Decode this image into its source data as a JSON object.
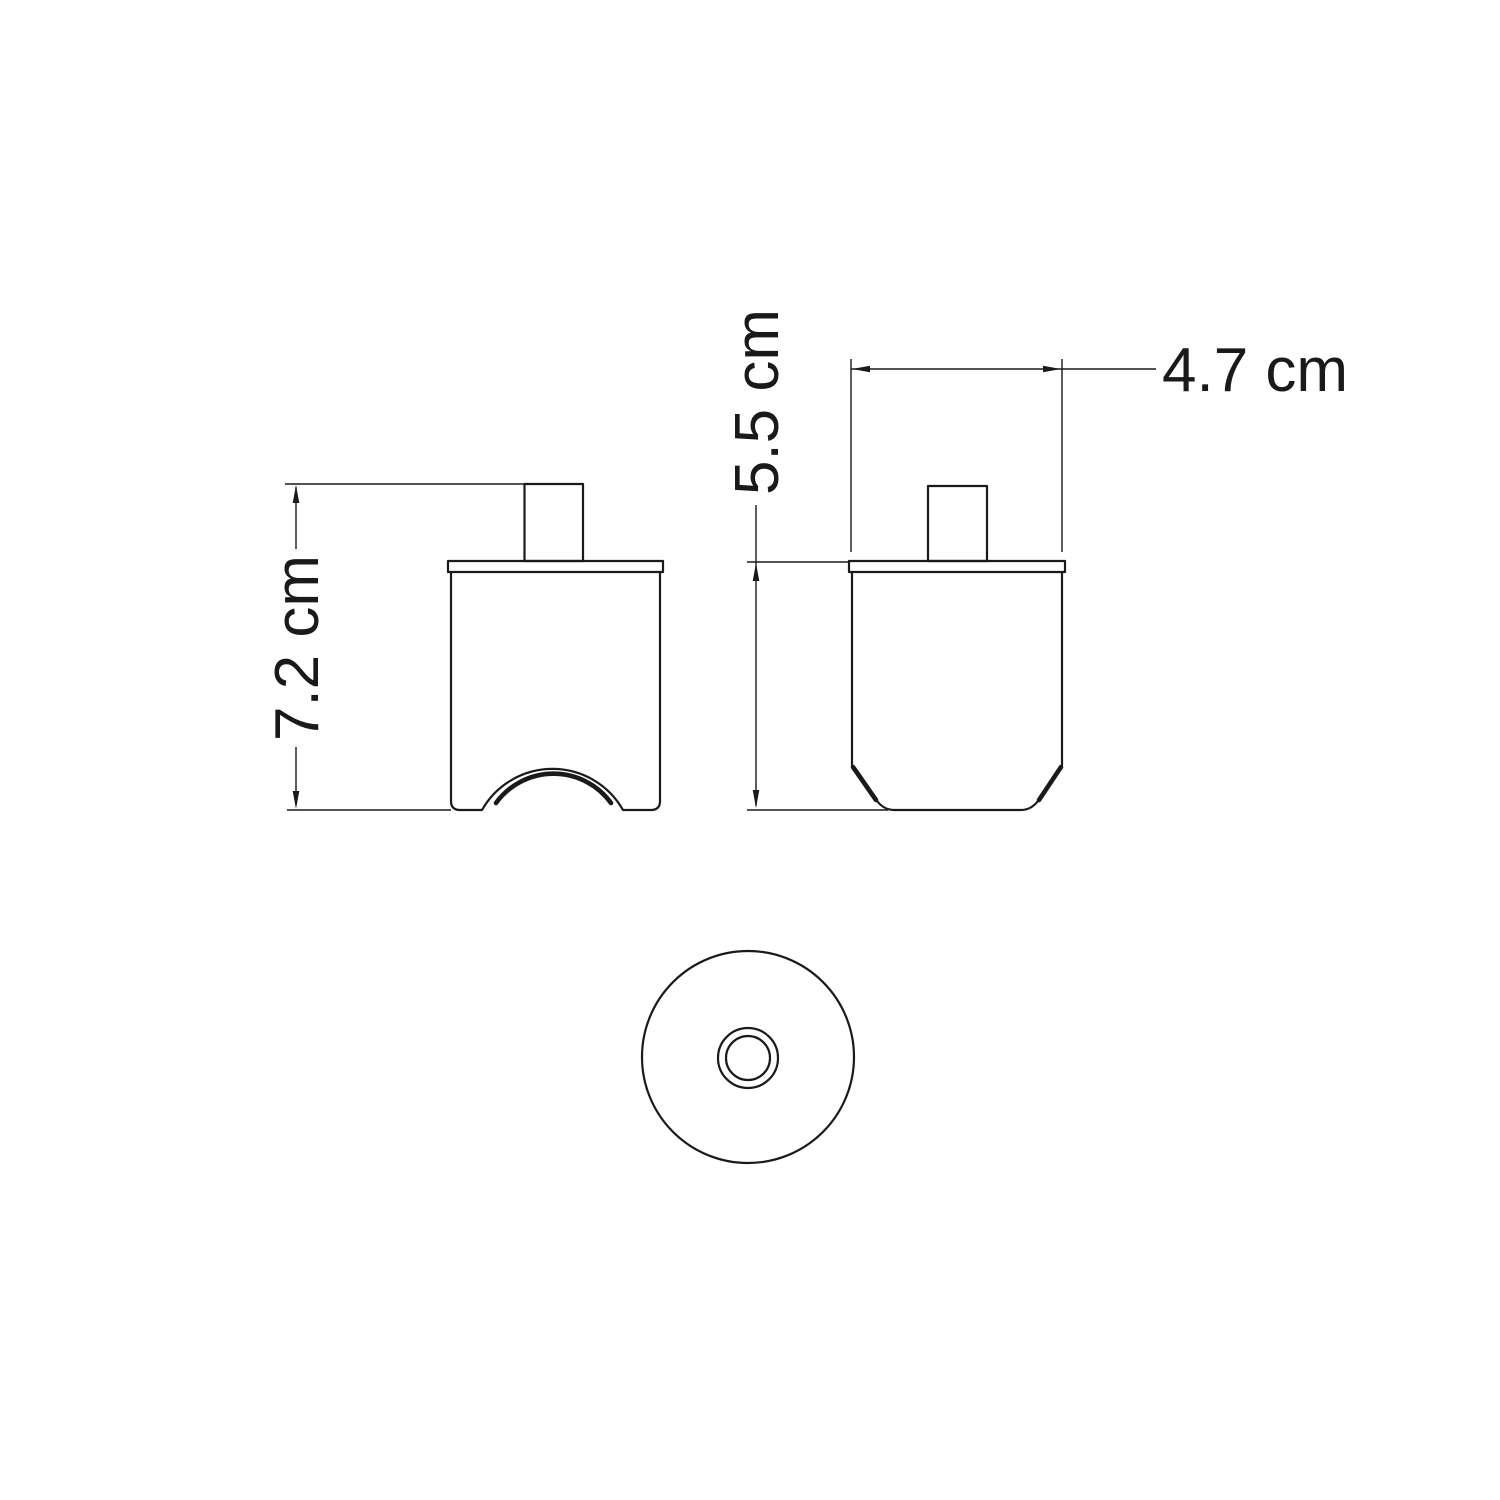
{
  "canvas": {
    "background": "#ffffff",
    "line_color": "#1a1a1a"
  },
  "dimensions": {
    "side_height": {
      "label": "7.2 cm",
      "value": 7.2,
      "unit": "cm"
    },
    "front_height": {
      "label": "5.5 cm",
      "value": 5.5,
      "unit": "cm"
    },
    "front_width": {
      "label": "4.7 cm",
      "value": 4.7,
      "unit": "cm"
    }
  }
}
